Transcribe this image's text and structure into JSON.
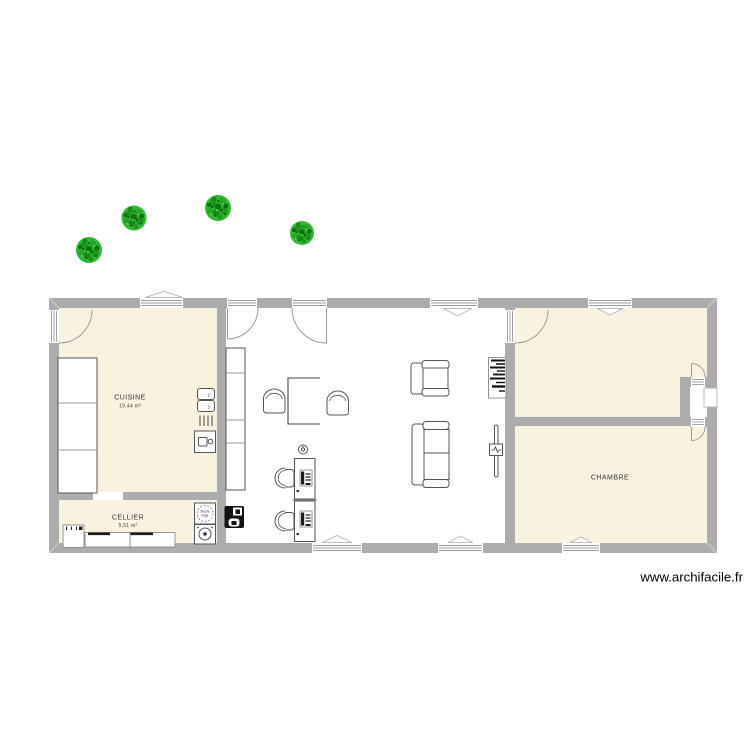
{
  "meta": {
    "watermark": "www.archifacile.fr"
  },
  "colors": {
    "wall": "#acacac",
    "room_fill": "#f8f2de",
    "living_fill": "#ffffff",
    "furniture_line": "#555555",
    "label_text": "#333333",
    "tree_green": "#2cbb2c",
    "tree_dark": "#0d6e0d",
    "watermark_text": "#000000"
  },
  "rooms": [
    {
      "id": "cuisine",
      "name": "CUISINE",
      "area": "19,44 m²"
    },
    {
      "id": "cellier",
      "name": "CELLIER",
      "area": "5,51 m²"
    },
    {
      "id": "chambre",
      "name": "CHAMBRE",
      "area": ""
    }
  ],
  "appliances": {
    "dryer_line1": "Sèche",
    "dryer_line2": "linge"
  },
  "icons": [
    "tree-icon",
    "door-arc-icon",
    "window-icon",
    "sink-icon",
    "hob-icon",
    "oven-icon",
    "dryer-icon",
    "washer-icon",
    "boiler-icon",
    "bookshelf-icon",
    "radiator-icon",
    "monitor-icon",
    "clock-icon",
    "chair-icon",
    "sofa-icon",
    "armchair-icon"
  ]
}
